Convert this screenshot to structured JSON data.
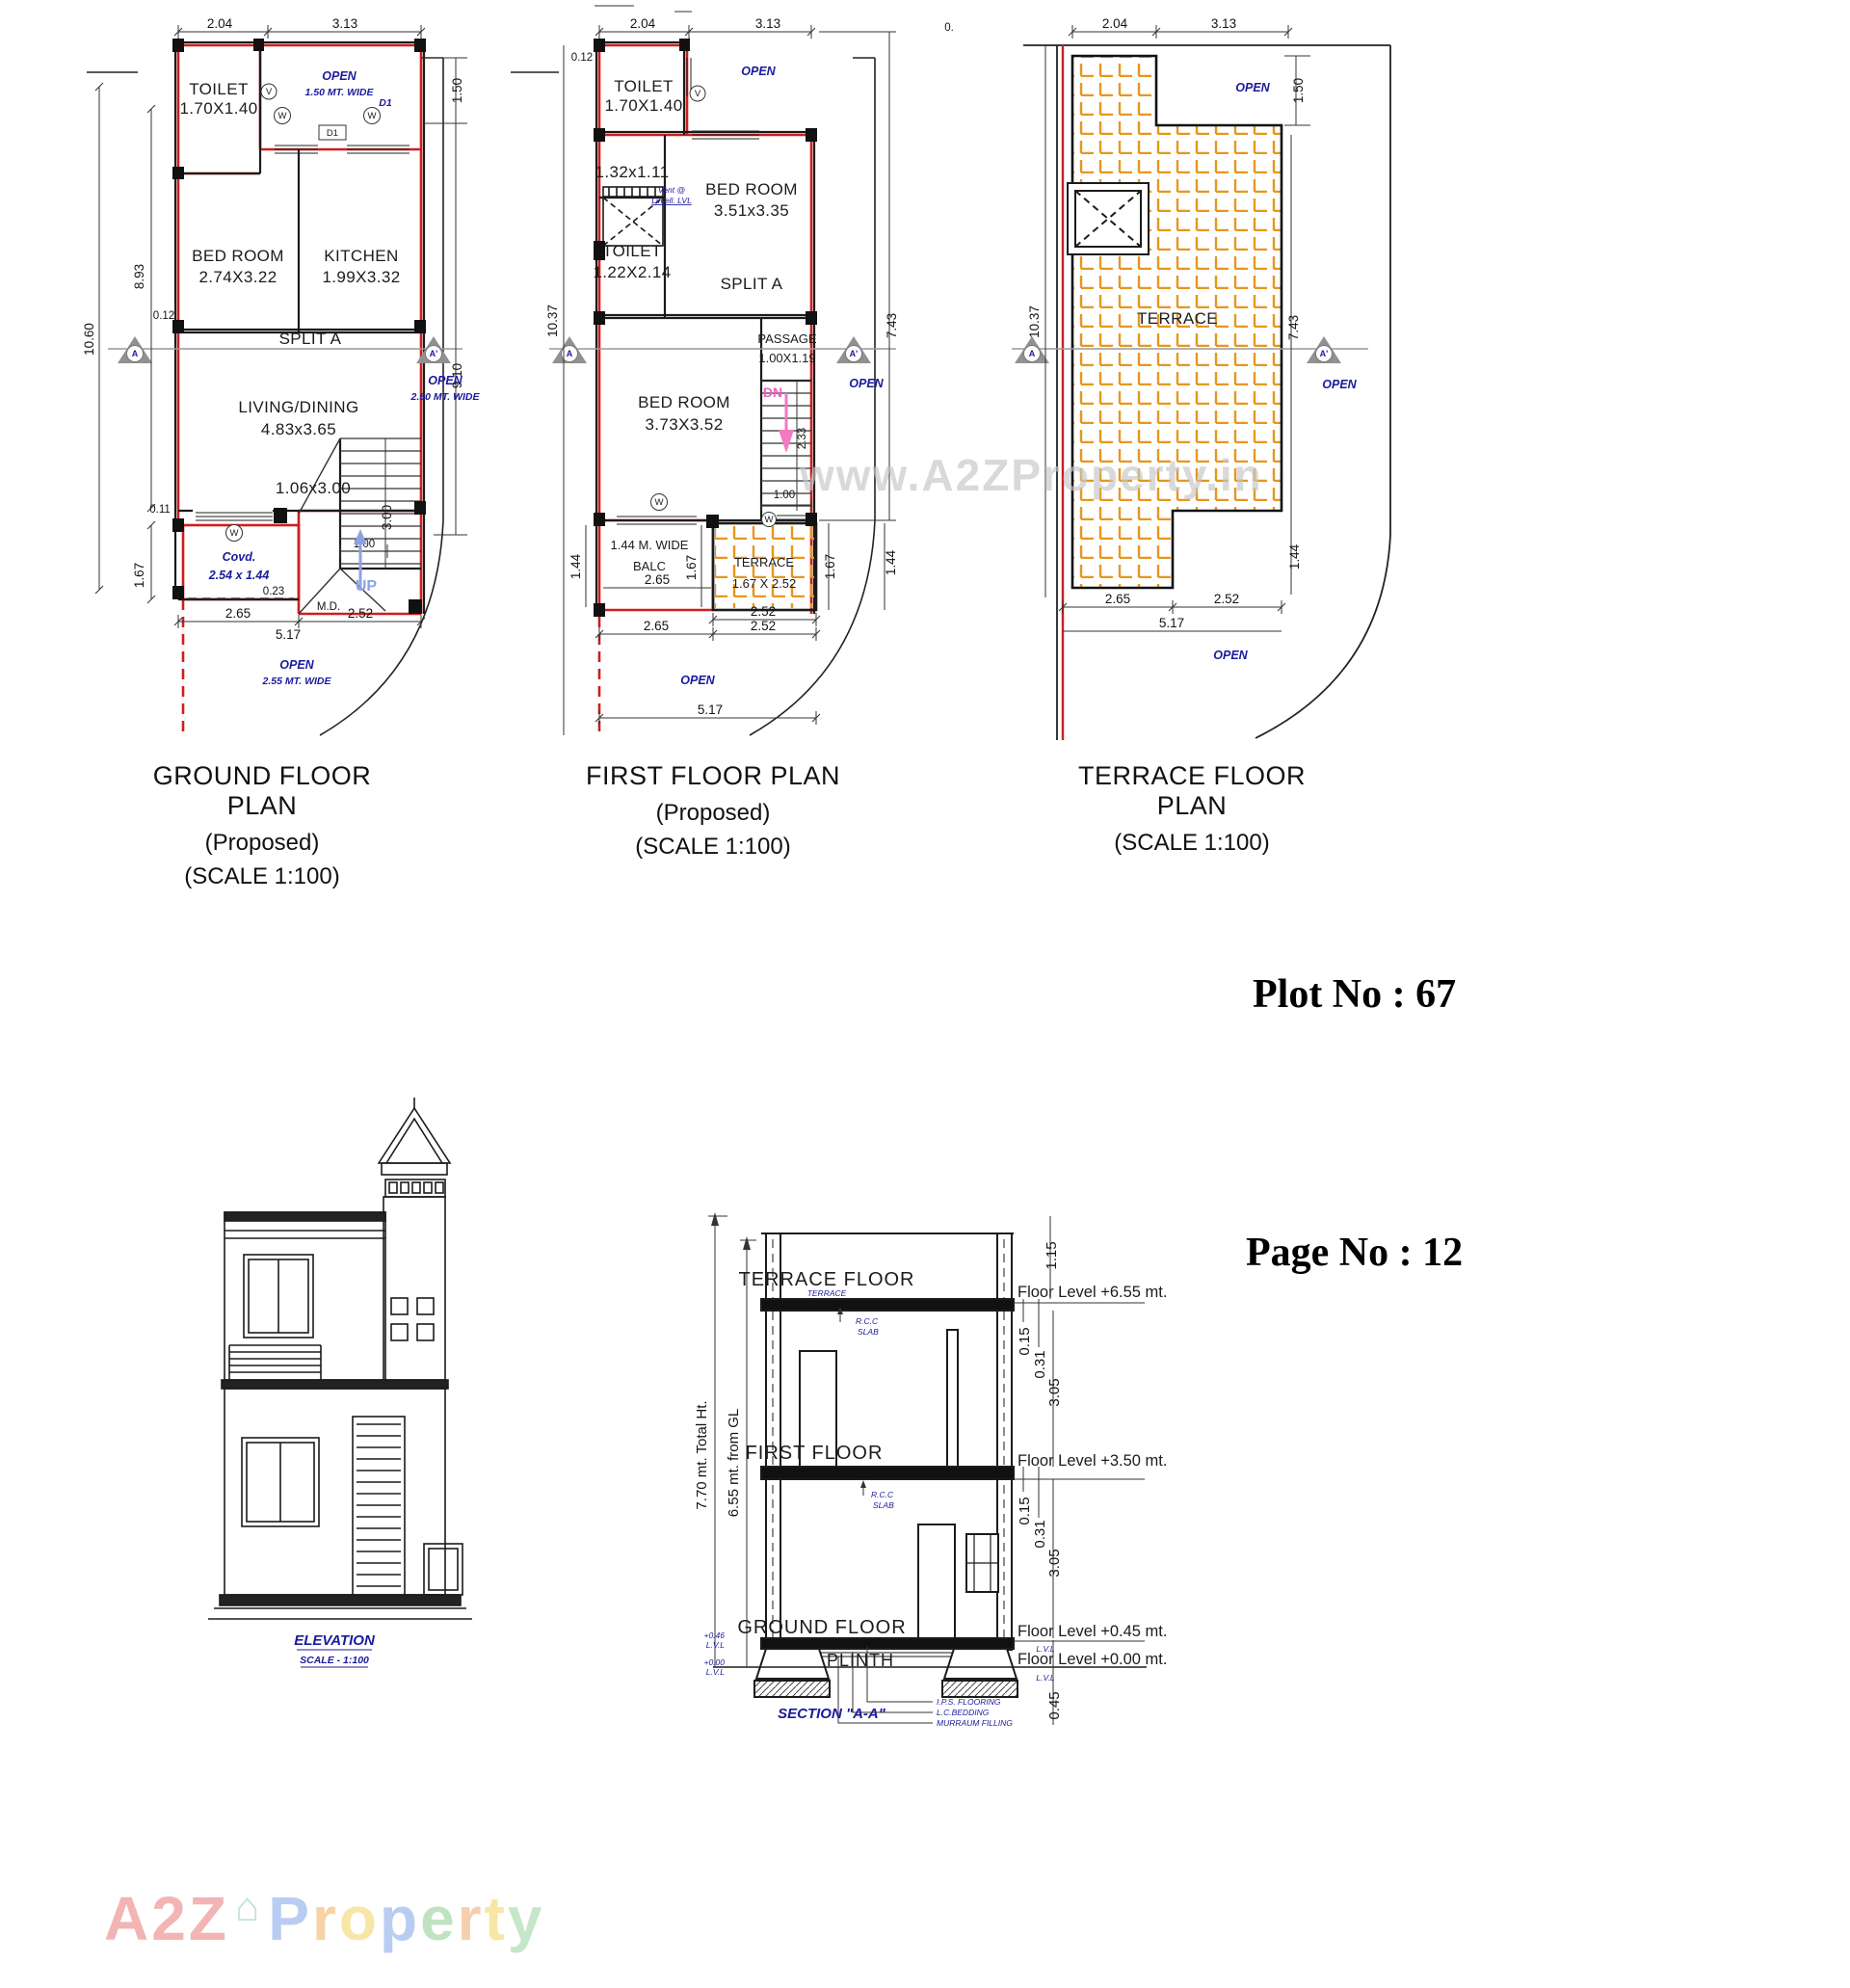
{
  "page": {
    "plot": "Plot No : 67",
    "pageno": "Page No : 12",
    "wm": "www.A2ZProperty.in",
    "frag": "0."
  },
  "brand": {
    "a2z": "A2Z",
    "house": "⌂",
    "letters": [
      "P",
      "r",
      "o",
      "p",
      "e",
      "r",
      "t",
      "y"
    ]
  },
  "colors": {
    "wall_red": "#cc1f1f",
    "annot_blue": "#1b1b9e",
    "hatch_orange": "#e8961e",
    "up_blue": "#8fa2e0",
    "dn_pink": "#ee5fc0",
    "triangle_gray": "#919191",
    "watermark_gray": "#c6c6c6"
  },
  "gf": {
    "title": "GROUND FLOOR PLAN",
    "subtitle": "(Proposed)",
    "scale": "(SCALE 1:100)",
    "toilet1": "TOILET",
    "toilet2": "1.70X1.40",
    "open_top1": "OPEN",
    "open_top2": "1.50 MT. WIDE",
    "bed1": "BED ROOM",
    "bed2": "2.74X3.22",
    "kit1": "KITCHEN",
    "kit2": "1.99X3.32",
    "split": "SPLIT A",
    "living1": "LIVING/DINING",
    "living2": "4.83x3.65",
    "stair": "1.06x3.00",
    "covd1": "Covd.",
    "covd2": "2.54 x 1.44",
    "md": "M.D.",
    "up": "UP",
    "open_right1": "OPEN",
    "open_right2": "2.50 MT. WIDE",
    "open_bot1": "OPEN",
    "open_bot2": "2.55 MT. WIDE",
    "d_top1": "2.04",
    "d_top2": "3.13",
    "d_left_total": "10.60",
    "d_left_up": "8.93",
    "d_left_low": "1.67",
    "d_w1": "0.12",
    "d_w2": "0.11",
    "d_right_top": "1.50",
    "d_right_mid": "9.10",
    "d_stair_w": "1.00",
    "d_stair_h": "3.00",
    "d_off": "0.23",
    "d_b1": "2.65",
    "d_b2": "5.17",
    "d_b3": "2.52",
    "w": "W",
    "v": "V",
    "d1": "D1",
    "a": "A",
    "ap": "A'"
  },
  "ff": {
    "title": "FIRST FLOOR PLAN",
    "subtitle": "(Proposed)",
    "scale": "(SCALE 1:100)",
    "toilet1": "TOILET",
    "toilet2": "1.70X1.40",
    "store": "1.32x1.11",
    "vent1": "Vent @",
    "vent2": "Lintell. LVL",
    "toiletb1": "TOILET",
    "toiletb2": "1.22X2.14",
    "bed1a": "BED ROOM",
    "bed1b": "3.51x3.35",
    "split": "SPLIT A",
    "passage1": "PASSAGE",
    "passage2": "1.00X1.19",
    "dn": "DN",
    "bed2a": "BED ROOM",
    "bed2b": "3.73X3.52",
    "balc1": "1.44 M. WIDE",
    "balc2": "BALC",
    "terr1": "TERRACE",
    "terr2": "1.67 X 2.52",
    "open_top": "OPEN",
    "open_right": "OPEN",
    "open_bot": "OPEN",
    "d_top1": "2.04",
    "d_top2": "3.13",
    "d_w": "0.12",
    "d_left": "10.37",
    "d_right": "7.43",
    "d_stair": "2.33",
    "d_stair_w": "1.00",
    "d_balc_l": "1.44",
    "d_balc_w": "2.65",
    "d_balc_d": "1.67",
    "d_terr_d": "1.67",
    "d_right_low": "1.44",
    "d_b1": "2.52",
    "d_b2": "2.65",
    "d_b3": "2.52",
    "d_b4": "5.17",
    "w": "W",
    "v": "V",
    "a": "A",
    "ap": "A'"
  },
  "tf": {
    "title": "TERRACE FLOOR PLAN",
    "scale": "(SCALE 1:100)",
    "terrace": "TERRACE",
    "open_top": "OPEN",
    "open_right": "OPEN",
    "open_bot": "OPEN",
    "d_top1": "2.04",
    "d_top2": "3.13",
    "d_right_top": "1.50",
    "d_left": "10.37",
    "d_right": "7.43",
    "d_right_low": "1.44",
    "d_b1": "2.65",
    "d_b2": "2.52",
    "d_b3": "5.17",
    "a": "A",
    "ap": "A'"
  },
  "el": {
    "title": "ELEVATION",
    "scale": "SCALE - 1:100"
  },
  "sec": {
    "terrace_floor": "TERRACE FLOOR",
    "terrace_sm": "TERRACE",
    "rcc1": "R.C.C",
    "rcc2": "SLAB",
    "first_floor": "FIRST FLOOR",
    "ground_floor": "GROUND FLOOR",
    "plinth": "PLINTH",
    "caption": "SECTION \"A-A\"",
    "total_ht": "7.70 mt. Total Ht.",
    "from_gl": "6.55 mt. from GL",
    "lvl6": "Floor Level +6.55 mt.",
    "lvl3": "Floor Level +3.50 mt.",
    "lvl045": "Floor Level +0.45 mt.",
    "lvl0": "Floor Level +0.00 mt.",
    "lvl": "L.V.L",
    "pl1": "+0.46",
    "pl2": "+0.00",
    "d115": "1.15",
    "d015": "0.15",
    "d031": "0.31",
    "d305": "3.05",
    "d045": "0.45",
    "n1": "I.P.S. FLOORING",
    "n2": "L.C.BEDDING",
    "n3": "MURRAUM FILLING"
  }
}
